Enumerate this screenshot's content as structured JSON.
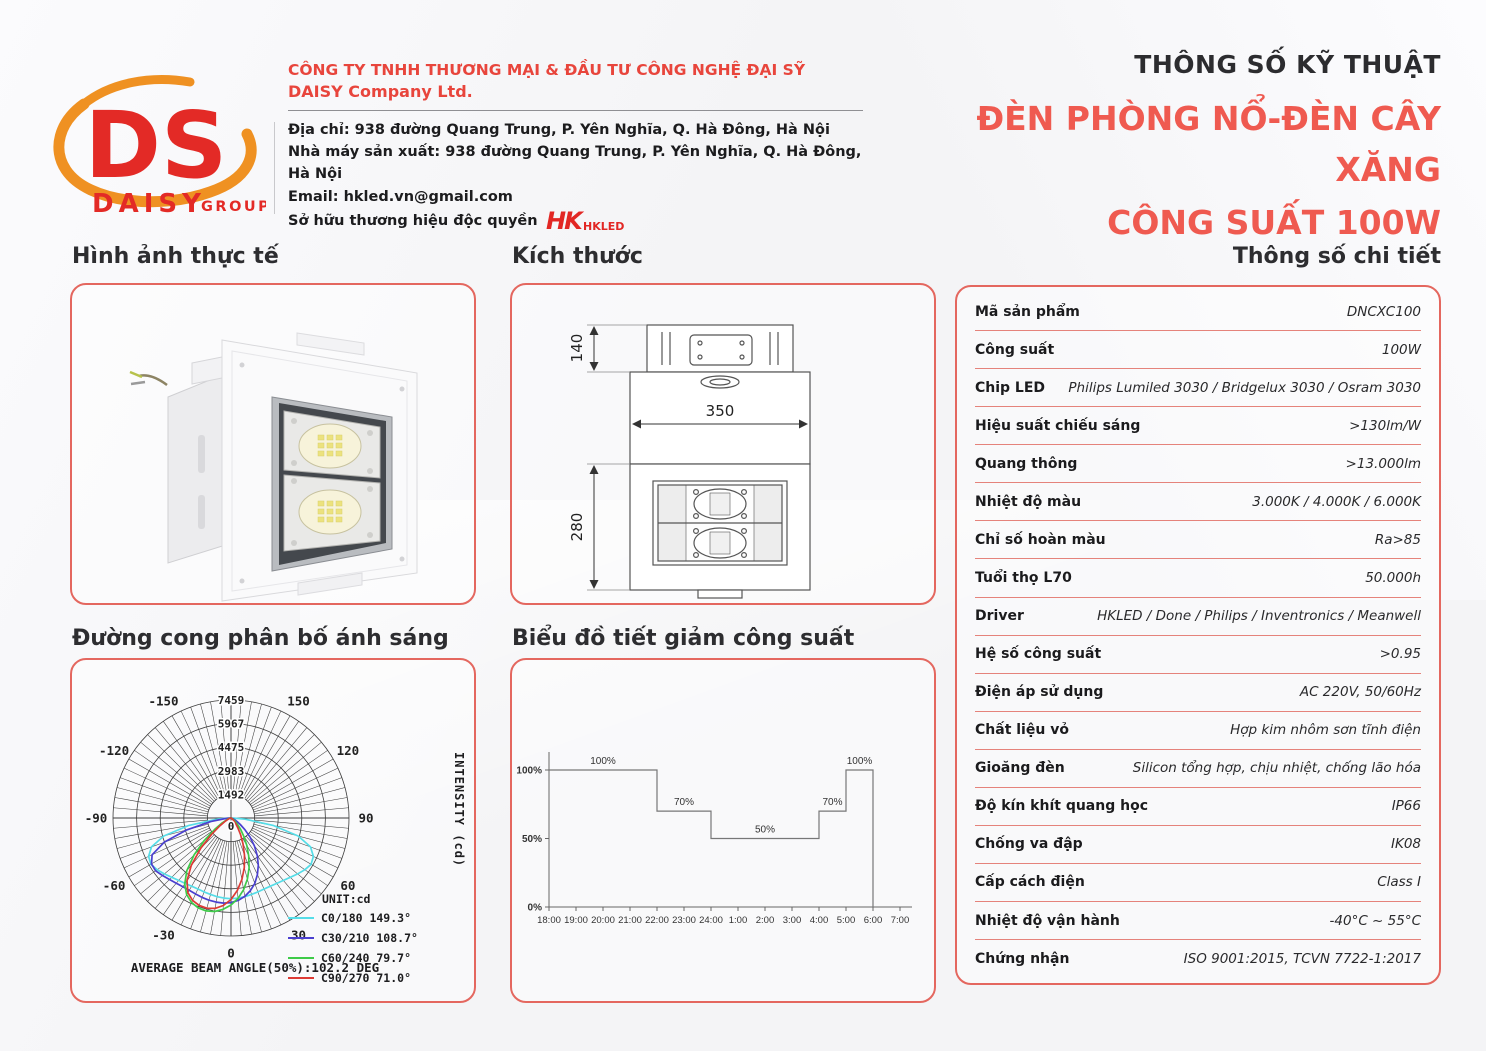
{
  "header": {
    "logo": {
      "monogram": "DS",
      "brand": "DAISY",
      "brand_suffix": "GROUP"
    },
    "company": {
      "name_vi": "CÔNG TY TNHH THƯƠNG MẠI & ĐẦU TƯ CÔNG NGHỆ ĐẠI SỸ",
      "name_en": "DAISY Company Ltd.",
      "address": "Địa chỉ: 938 đường Quang Trung, P. Yên Nghĩa, Q. Hà Đông, Hà Nội",
      "factory": "Nhà máy sản xuất: 938 đường Quang Trung, P. Yên Nghĩa, Q. Hà Đông, Hà Nội",
      "email": "Email: hkled.vn@gmail.com",
      "trademark": "Sở hữu thương hiệu độc quyền",
      "trademark_mark": "HK",
      "trademark_name": "HKLED"
    },
    "doc_title": "THÔNG SỐ KỸ THUẬT",
    "product_title_line1": "ĐÈN PHÒNG NỔ-ĐÈN CÂY XĂNG",
    "product_title_line2": "CÔNG SUẤT 100W"
  },
  "sections": {
    "photo": "Hình ảnh thực tế",
    "dimensions": "Kích thước",
    "specs": "Thông số chi tiết",
    "distribution": "Đường cong phân bố ánh sáng",
    "dimming": "Biểu đồ tiết giảm công suất"
  },
  "specs": {
    "rows": [
      {
        "label": "Mã sản phẩm",
        "value": "DNCXC100"
      },
      {
        "label": "Công suất",
        "value": "100W"
      },
      {
        "label": "Chip LED",
        "value": "Philips Lumiled 3030 / Bridgelux 3030 / Osram 3030"
      },
      {
        "label": "Hiệu suất chiếu sáng",
        "value": ">130lm/W"
      },
      {
        "label": "Quang thông",
        "value": ">13.000lm"
      },
      {
        "label": "Nhiệt độ màu",
        "value": "3.000K / 4.000K / 6.000K"
      },
      {
        "label": "Chỉ số hoàn màu",
        "value": "Ra>85"
      },
      {
        "label": "Tuổi thọ L70",
        "value": "50.000h"
      },
      {
        "label": "Driver",
        "value": "HKLED / Done / Philips / Inventronics / Meanwell"
      },
      {
        "label": "Hệ số công suất",
        "value": ">0.95"
      },
      {
        "label": "Điện áp sử dụng",
        "value": "AC 220V, 50/60Hz"
      },
      {
        "label": "Chất liệu vỏ",
        "value": "Hợp kim nhôm sơn tĩnh điện"
      },
      {
        "label": "Gioăng đèn",
        "value": "Silicon tổng hợp, chịu nhiệt, chống lão hóa"
      },
      {
        "label": "Độ kín khít quang học",
        "value": "IP66"
      },
      {
        "label": "Chống va đập",
        "value": "IK08"
      },
      {
        "label": "Cấp cách điện",
        "value": "Class I"
      },
      {
        "label": "Nhiệt độ vận hành",
        "value": "-40°C ~ 55°C"
      },
      {
        "label": "Chứng nhận",
        "value": "ISO 9001:2015, TCVN 7722-1:2017"
      }
    ]
  },
  "dimensions_drawing": {
    "top_height": "140",
    "width": "350",
    "body_height": "280"
  },
  "chart_data": [
    {
      "type": "line",
      "subtype": "polar",
      "title": "Đường cong phân bố ánh sáng",
      "ylabel": "INTENSITY (cd)",
      "unit_label": "UNIT:cd",
      "annotation": "AVERAGE BEAM ANGLE(50%):102.2 DEG",
      "radial_ticks": [
        0,
        1492,
        2983,
        4475,
        5967,
        7459
      ],
      "angle_ticks": [
        -150,
        -120,
        -90,
        -60,
        -30,
        0,
        30,
        60,
        90,
        120,
        150
      ],
      "rlim": [
        0,
        7459
      ],
      "legend_position": "bottom-right",
      "grid": true,
      "series": [
        {
          "name": "C0/180 149.3°",
          "color": "#55dde8",
          "points": [
            [
              -90,
              100
            ],
            [
              -85,
              900
            ],
            [
              -80,
              2700
            ],
            [
              -75,
              4400
            ],
            [
              -70,
              5350
            ],
            [
              -65,
              5750
            ],
            [
              -60,
              5850
            ],
            [
              -55,
              5700
            ],
            [
              -50,
              5500
            ],
            [
              -45,
              5300
            ],
            [
              -40,
              5150
            ],
            [
              -35,
              5050
            ],
            [
              -30,
              4980
            ],
            [
              -25,
              4950
            ],
            [
              -20,
              4970
            ],
            [
              -15,
              5000
            ],
            [
              -10,
              5050
            ],
            [
              -5,
              5080
            ],
            [
              0,
              5100
            ],
            [
              5,
              5080
            ],
            [
              10,
              5050
            ],
            [
              15,
              5000
            ],
            [
              20,
              4970
            ],
            [
              25,
              4950
            ],
            [
              30,
              4980
            ],
            [
              35,
              5050
            ],
            [
              40,
              5150
            ],
            [
              45,
              5300
            ],
            [
              50,
              5500
            ],
            [
              55,
              5700
            ],
            [
              60,
              5850
            ],
            [
              65,
              5750
            ],
            [
              70,
              5350
            ],
            [
              75,
              4400
            ],
            [
              80,
              2700
            ],
            [
              85,
              900
            ],
            [
              90,
              100
            ]
          ]
        },
        {
          "name": "C30/210 108.7°",
          "color": "#4a3fd0",
          "points": [
            [
              -90,
              60
            ],
            [
              -85,
              350
            ],
            [
              -80,
              1300
            ],
            [
              -75,
              2900
            ],
            [
              -70,
              4500
            ],
            [
              -65,
              5500
            ],
            [
              -60,
              5800
            ],
            [
              -55,
              5820
            ],
            [
              -50,
              5650
            ],
            [
              -45,
              5500
            ],
            [
              -40,
              5380
            ],
            [
              -35,
              5300
            ],
            [
              -30,
              5280
            ],
            [
              -25,
              5300
            ],
            [
              -20,
              5340
            ],
            [
              -15,
              5380
            ],
            [
              -10,
              5400
            ],
            [
              -5,
              5400
            ],
            [
              0,
              5350
            ],
            [
              5,
              5230
            ],
            [
              10,
              5030
            ],
            [
              15,
              4750
            ],
            [
              20,
              4400
            ],
            [
              25,
              3950
            ],
            [
              30,
              3450
            ],
            [
              35,
              2900
            ],
            [
              40,
              2300
            ],
            [
              45,
              1700
            ],
            [
              50,
              1150
            ],
            [
              55,
              720
            ],
            [
              60,
              430
            ],
            [
              65,
              260
            ],
            [
              70,
              160
            ],
            [
              75,
              100
            ],
            [
              80,
              60
            ],
            [
              85,
              30
            ],
            [
              90,
              10
            ]
          ]
        },
        {
          "name": "C60/240 79.7°",
          "color": "#3ecb49",
          "points": [
            [
              -90,
              20
            ],
            [
              -80,
              90
            ],
            [
              -70,
              250
            ],
            [
              -60,
              700
            ],
            [
              -55,
              1250
            ],
            [
              -50,
              2200
            ],
            [
              -45,
              3300
            ],
            [
              -40,
              4350
            ],
            [
              -35,
              5100
            ],
            [
              -30,
              5600
            ],
            [
              -25,
              5900
            ],
            [
              -20,
              6050
            ],
            [
              -15,
              6080
            ],
            [
              -10,
              6000
            ],
            [
              -5,
              5800
            ],
            [
              0,
              5500
            ],
            [
              5,
              5100
            ],
            [
              10,
              4600
            ],
            [
              15,
              4000
            ],
            [
              20,
              3350
            ],
            [
              25,
              2650
            ],
            [
              30,
              2000
            ],
            [
              35,
              1400
            ],
            [
              40,
              950
            ],
            [
              45,
              600
            ],
            [
              50,
              370
            ],
            [
              55,
              230
            ],
            [
              60,
              140
            ],
            [
              70,
              60
            ],
            [
              80,
              25
            ],
            [
              90,
              8
            ]
          ]
        },
        {
          "name": "C90/270 71.0°",
          "color": "#dd3a34",
          "points": [
            [
              -90,
              15
            ],
            [
              -80,
              60
            ],
            [
              -70,
              160
            ],
            [
              -60,
              450
            ],
            [
              -55,
              850
            ],
            [
              -50,
              1600
            ],
            [
              -45,
              2700
            ],
            [
              -40,
              3900
            ],
            [
              -35,
              4850
            ],
            [
              -30,
              5450
            ],
            [
              -25,
              5750
            ],
            [
              -20,
              5880
            ],
            [
              -15,
              5900
            ],
            [
              -10,
              5800
            ],
            [
              -5,
              5550
            ],
            [
              0,
              5150
            ],
            [
              5,
              4600
            ],
            [
              10,
              3950
            ],
            [
              15,
              3250
            ],
            [
              20,
              2500
            ],
            [
              25,
              1800
            ],
            [
              30,
              1200
            ],
            [
              35,
              750
            ],
            [
              40,
              450
            ],
            [
              45,
              260
            ],
            [
              50,
              150
            ],
            [
              55,
              95
            ],
            [
              60,
              60
            ],
            [
              70,
              30
            ],
            [
              80,
              12
            ],
            [
              90,
              4
            ]
          ]
        }
      ]
    },
    {
      "type": "line",
      "subtype": "step",
      "title": "Biểu đồ tiết giảm công suất",
      "x_ticks": [
        "18:00",
        "19:00",
        "20:00",
        "21:00",
        "22:00",
        "23:00",
        "24:00",
        "1:00",
        "2:00",
        "3:00",
        "4:00",
        "5:00",
        "6:00",
        "7:00"
      ],
      "y_ticks": [
        {
          "label": "0%",
          "level": 0
        },
        {
          "label": "50%",
          "level": 50
        },
        {
          "label": "100%",
          "level": 100
        }
      ],
      "ylim": [
        0,
        115
      ],
      "segments": [
        {
          "label": "100%",
          "from": "18:00",
          "to": "22:00",
          "level": 100
        },
        {
          "label": "70%",
          "from": "22:00",
          "to": "24:00",
          "level": 70
        },
        {
          "label": "50%",
          "from": "24:00",
          "to": "4:00",
          "level": 50
        },
        {
          "label": "70%",
          "from": "4:00",
          "to": "5:00",
          "level": 70
        },
        {
          "label": "100%",
          "from": "5:00",
          "to": "6:00",
          "level": 100
        }
      ]
    }
  ]
}
